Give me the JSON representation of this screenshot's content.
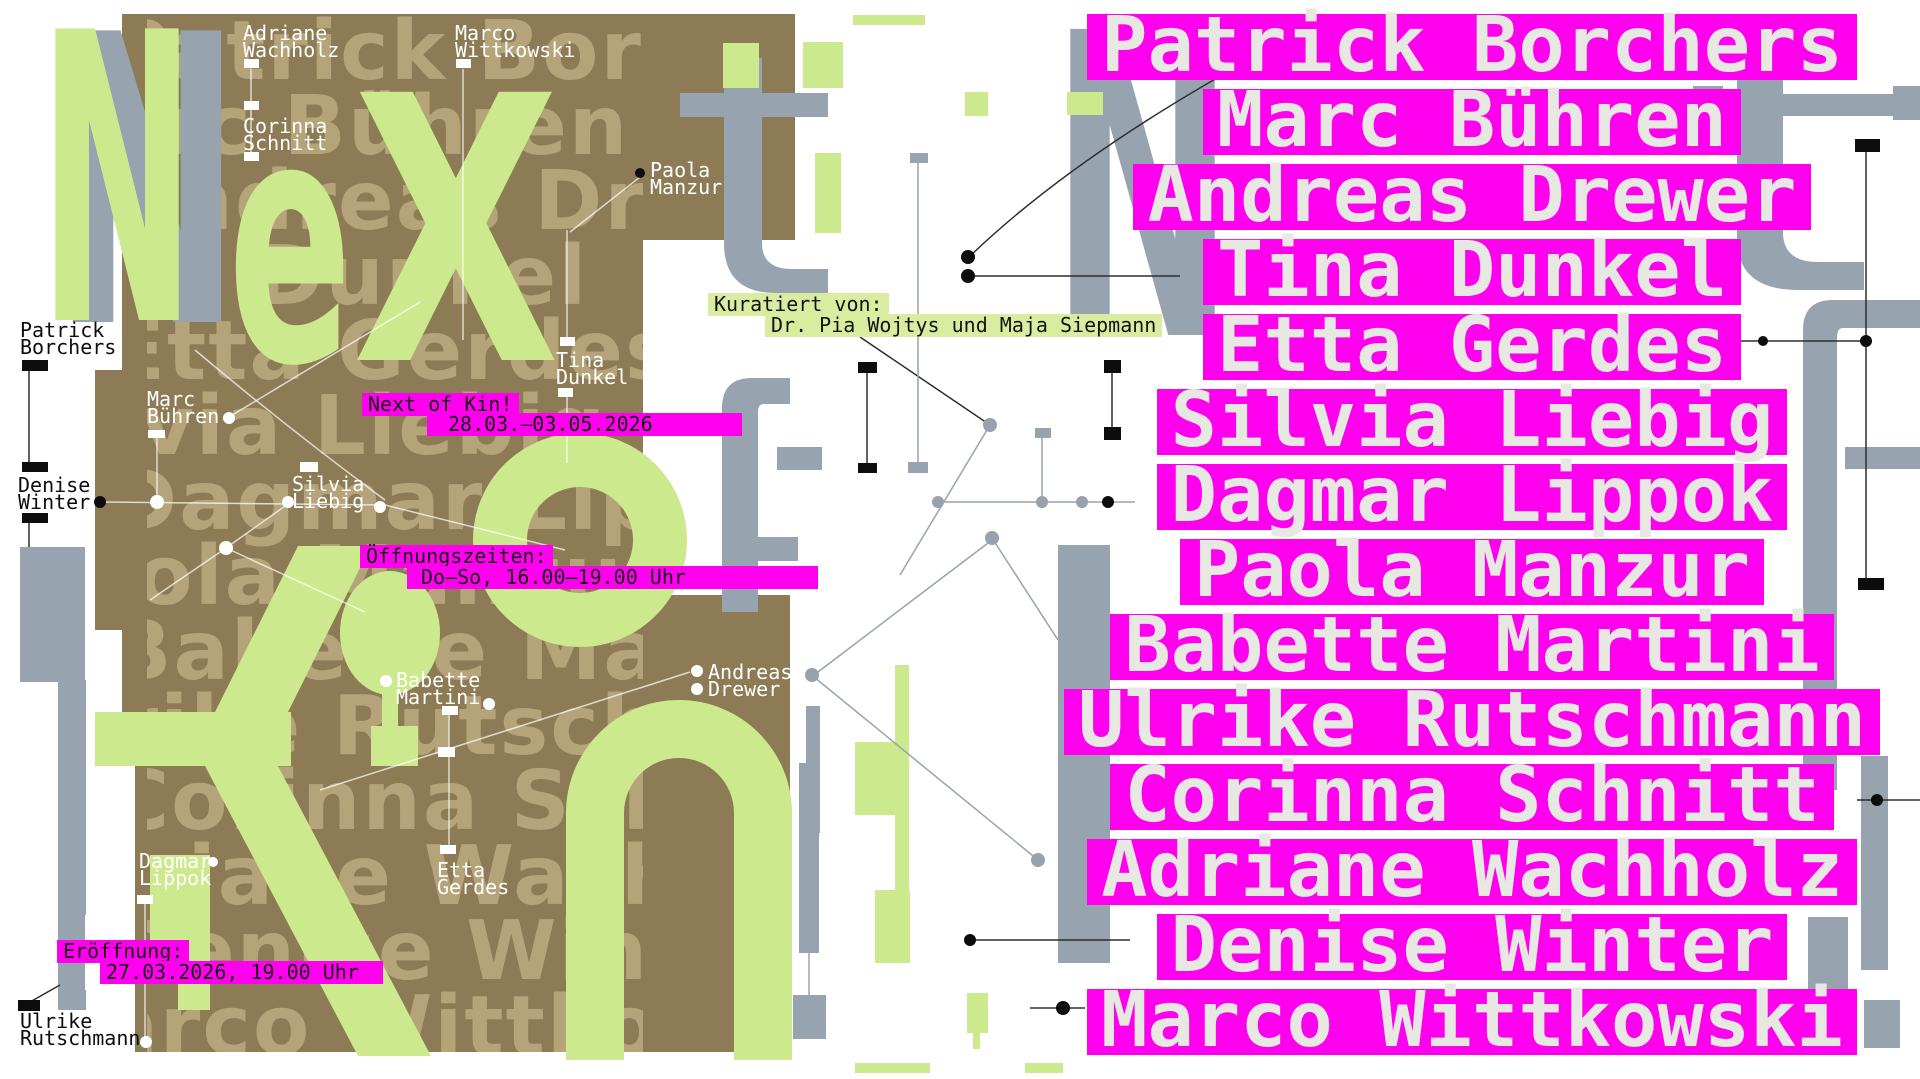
{
  "colors": {
    "magenta": "#ff00ee",
    "highlight_green": "#d9ec9f",
    "letter_green": "#cde98e",
    "brown": "#8d7b55",
    "gray": "#98a3b0",
    "row_text": "#e6e8e1"
  },
  "big_letters": {
    "green_n": "N",
    "green_e": "e",
    "green_x": "X",
    "gray_n_left": "N",
    "gray_n_right": "N",
    "gray_t": "t",
    "gray_f": "f",
    "gray_excl": "!",
    "green_o": "o",
    "green_k": "K",
    "green_i": "i",
    "green_n2": "n"
  },
  "info": {
    "curated_label": "Kuratiert von:",
    "curated_names": "Dr. Pia Wojtys und Maja Siepmann",
    "title": "Next of Kin!",
    "dates": "28.03.–03.05.2026",
    "hours_label": "Öffnungszeiten:",
    "hours_value": "Do–So, 16.00–19.00 Uhr",
    "opening_label": "Eröffnung:",
    "opening_value": "27.03.2026, 19.00 Uhr"
  },
  "left_labels": [
    {
      "line1": "Adriane",
      "line2": "Wachholz"
    },
    {
      "line1": "Corinna",
      "line2": "Schnitt"
    },
    {
      "line1": "Marco",
      "line2": "Wittkowski"
    },
    {
      "line1": "Paola",
      "line2": "Manzur"
    },
    {
      "line1": "Patrick",
      "line2": "Borchers"
    },
    {
      "line1": "Tina",
      "line2": "Dunkel"
    },
    {
      "line1": "Marc",
      "line2": "Bühren"
    },
    {
      "line1": "Denise",
      "line2": "Winter"
    },
    {
      "line1": "Silvia",
      "line2": "Liebig"
    },
    {
      "line1": "Babette",
      "line2": "Martini"
    },
    {
      "line1": "Andreas",
      "line2": "Drewer"
    },
    {
      "line1": "Dagmar",
      "line2": "Lippok"
    },
    {
      "line1": "Etta",
      "line2": "Gerdes"
    },
    {
      "line1": "Ulrike",
      "line2": "Rutschmann"
    }
  ],
  "artists": [
    "Patrick Borchers",
    "Marc Bühren",
    "Andreas Drewer",
    "Tina Dunkel",
    "Etta Gerdes",
    "Silvia Liebig",
    "Dagmar Lippok",
    "Paola Manzur",
    "Babette Martini",
    "Ulrike Rutschmann",
    "Corinna Schnitt",
    "Adriane Wachholz",
    "Denise Winter",
    "Marco Wittkowski"
  ]
}
